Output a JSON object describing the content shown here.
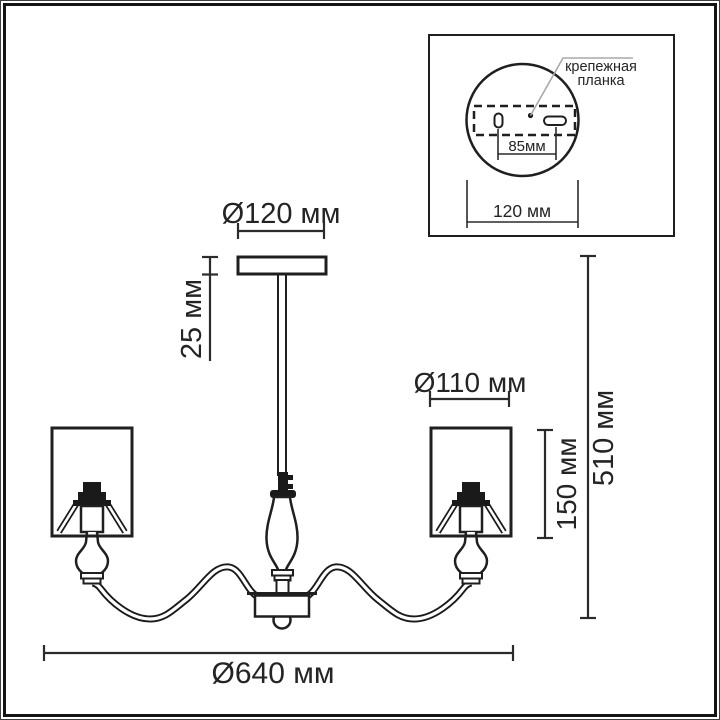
{
  "diagram": {
    "kind": "chandelier dimension drawing"
  },
  "inset": {
    "bracket_label_line1": "крепежная",
    "bracket_label_line2": "планка",
    "hole_spacing": "85мм",
    "plate_diameter": "120 мм"
  },
  "dimensions": {
    "canopy_diameter": "Ø120 мм",
    "canopy_height": "25 мм",
    "shade_diameter": "Ø110 мм",
    "shade_height": "150 мм",
    "total_height": "510 мм",
    "total_diameter": "Ø640 мм"
  },
  "colors": {
    "line": "#1f1f1f",
    "dimension": "#2b2b2b",
    "leader": "#a8a8a8",
    "background": "#ffffff"
  }
}
